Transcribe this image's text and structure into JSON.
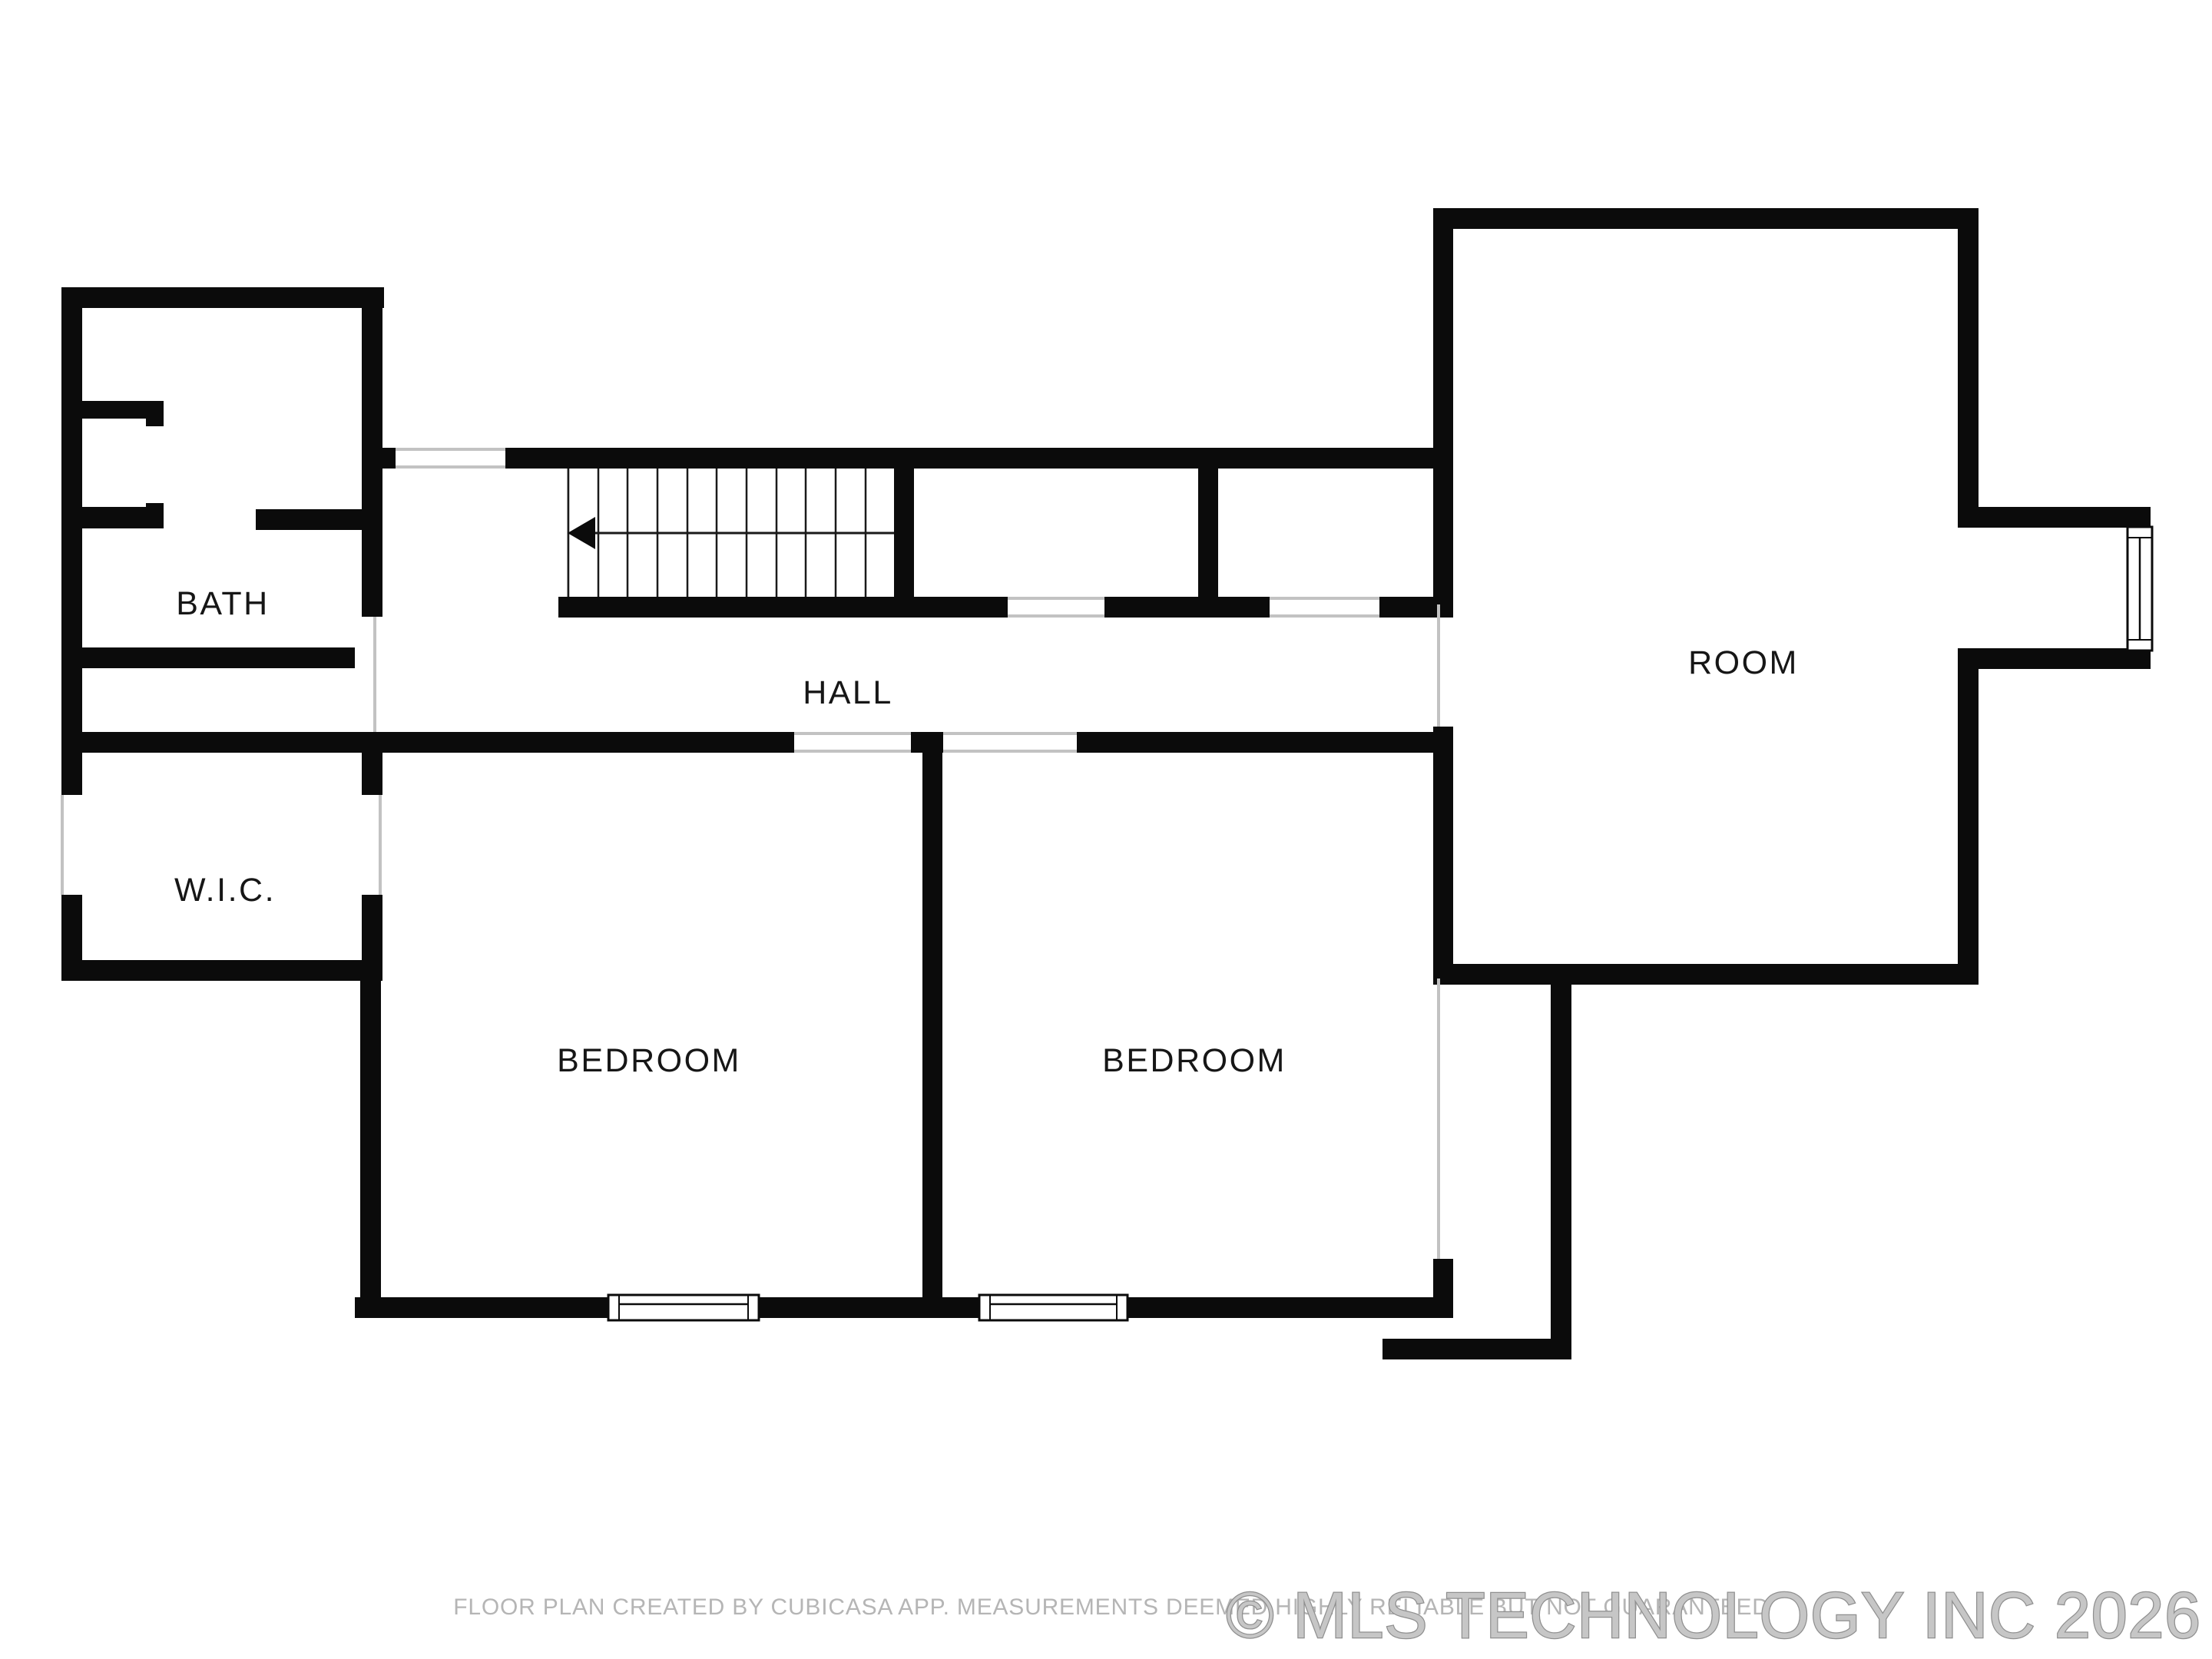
{
  "document": {
    "type": "floor-plan",
    "creator_note": "FLOOR PLAN CREATED BY CUBICASA APP. MEASUREMENTS DEEMED HIGHLY RELIABLE BUT NOT GUARANTEED",
    "watermark": "© MLS TECHNOLOGY INC 2026"
  },
  "rooms": [
    {
      "name": "bath",
      "label": "BATH"
    },
    {
      "name": "wic",
      "label": "W.I.C."
    },
    {
      "name": "hall",
      "label": "HALL"
    },
    {
      "name": "bedroom-left",
      "label": "BEDROOM"
    },
    {
      "name": "bedroom-right",
      "label": "BEDROOM"
    },
    {
      "name": "room",
      "label": "ROOM"
    }
  ],
  "stairs": {
    "tread_count": 11,
    "run_direction": "left"
  },
  "features": {
    "windows": 3,
    "door_openings": 9
  },
  "colors": {
    "background": "#ffffff",
    "wall": "#0b0b0b",
    "opening_line": "#c2c2c2",
    "stair_line": "#1a1a1a",
    "label_text": "#161616",
    "footer_text": "#b5b5b5",
    "watermark_fill": "#c6c6c6",
    "watermark_edge": "#8f8f8f"
  }
}
